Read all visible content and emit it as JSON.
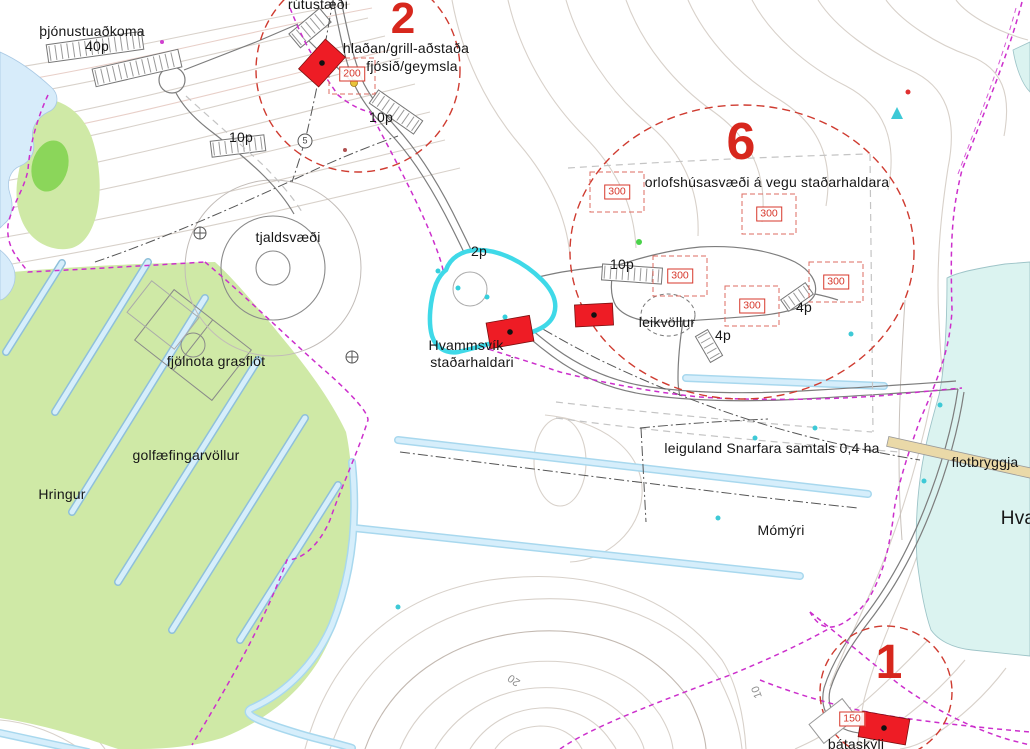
{
  "map": {
    "labels": {
      "service_access": "þjónustuaðkoma",
      "service_access_capacity": "40p",
      "bus_parking": "rútustæði",
      "area2_number": "2",
      "barn_grill": "hlaðan/grill-aðstaða",
      "cowshed_storage": "fjósið/geymsla",
      "parking_north": "10p",
      "parking_west": "10p",
      "campsite": "tjaldsvæði",
      "parking_2p": "2p",
      "area6_number": "6",
      "holiday_homes": "orlofshúsasvæði á vegu staðarhaldara",
      "parking_mid": "10p",
      "playground": "leikvöllur",
      "parking_4p_east": "4p",
      "parking_4p_south": "4p",
      "manager_line1": "Hvammsvík",
      "manager_line2": "staðarhaldari",
      "multiuse_field": "fjölnota grasflöt",
      "golf_practice": "golfæfingarvöllur",
      "hringur": "Hringur",
      "leased_land": "leiguland Snarfara samtals 0,4 ha",
      "floating_dock": "flotbryggja",
      "bay_name_partial": "Hva",
      "momyri": "Mómýri",
      "boat_shelter": "bátaskýli",
      "contour_20": "20",
      "contour_10": "10",
      "area1_number": "1",
      "survey_point": "5"
    },
    "size_markers": {
      "m200": "200",
      "m300_a": "300",
      "m300_b": "300",
      "m300_c": "300",
      "m300_d": "300",
      "m300_e": "300",
      "m150": "150"
    },
    "colors": {
      "building_red": "#ee1c25",
      "area_number_red": "#d7271d",
      "boundary_magenta": "#cc2fcc",
      "sea_water": "#dbf3f0",
      "lake_water": "#d7ecfa",
      "pond_outline": "#3fd9e8",
      "field_green": "#cfe9a6",
      "field_green_dark": "#8bd65a",
      "ditch_blue": "#d6eefb",
      "dock_tan": "#ead9a8",
      "contour_gray": "#d8d1ca"
    }
  }
}
